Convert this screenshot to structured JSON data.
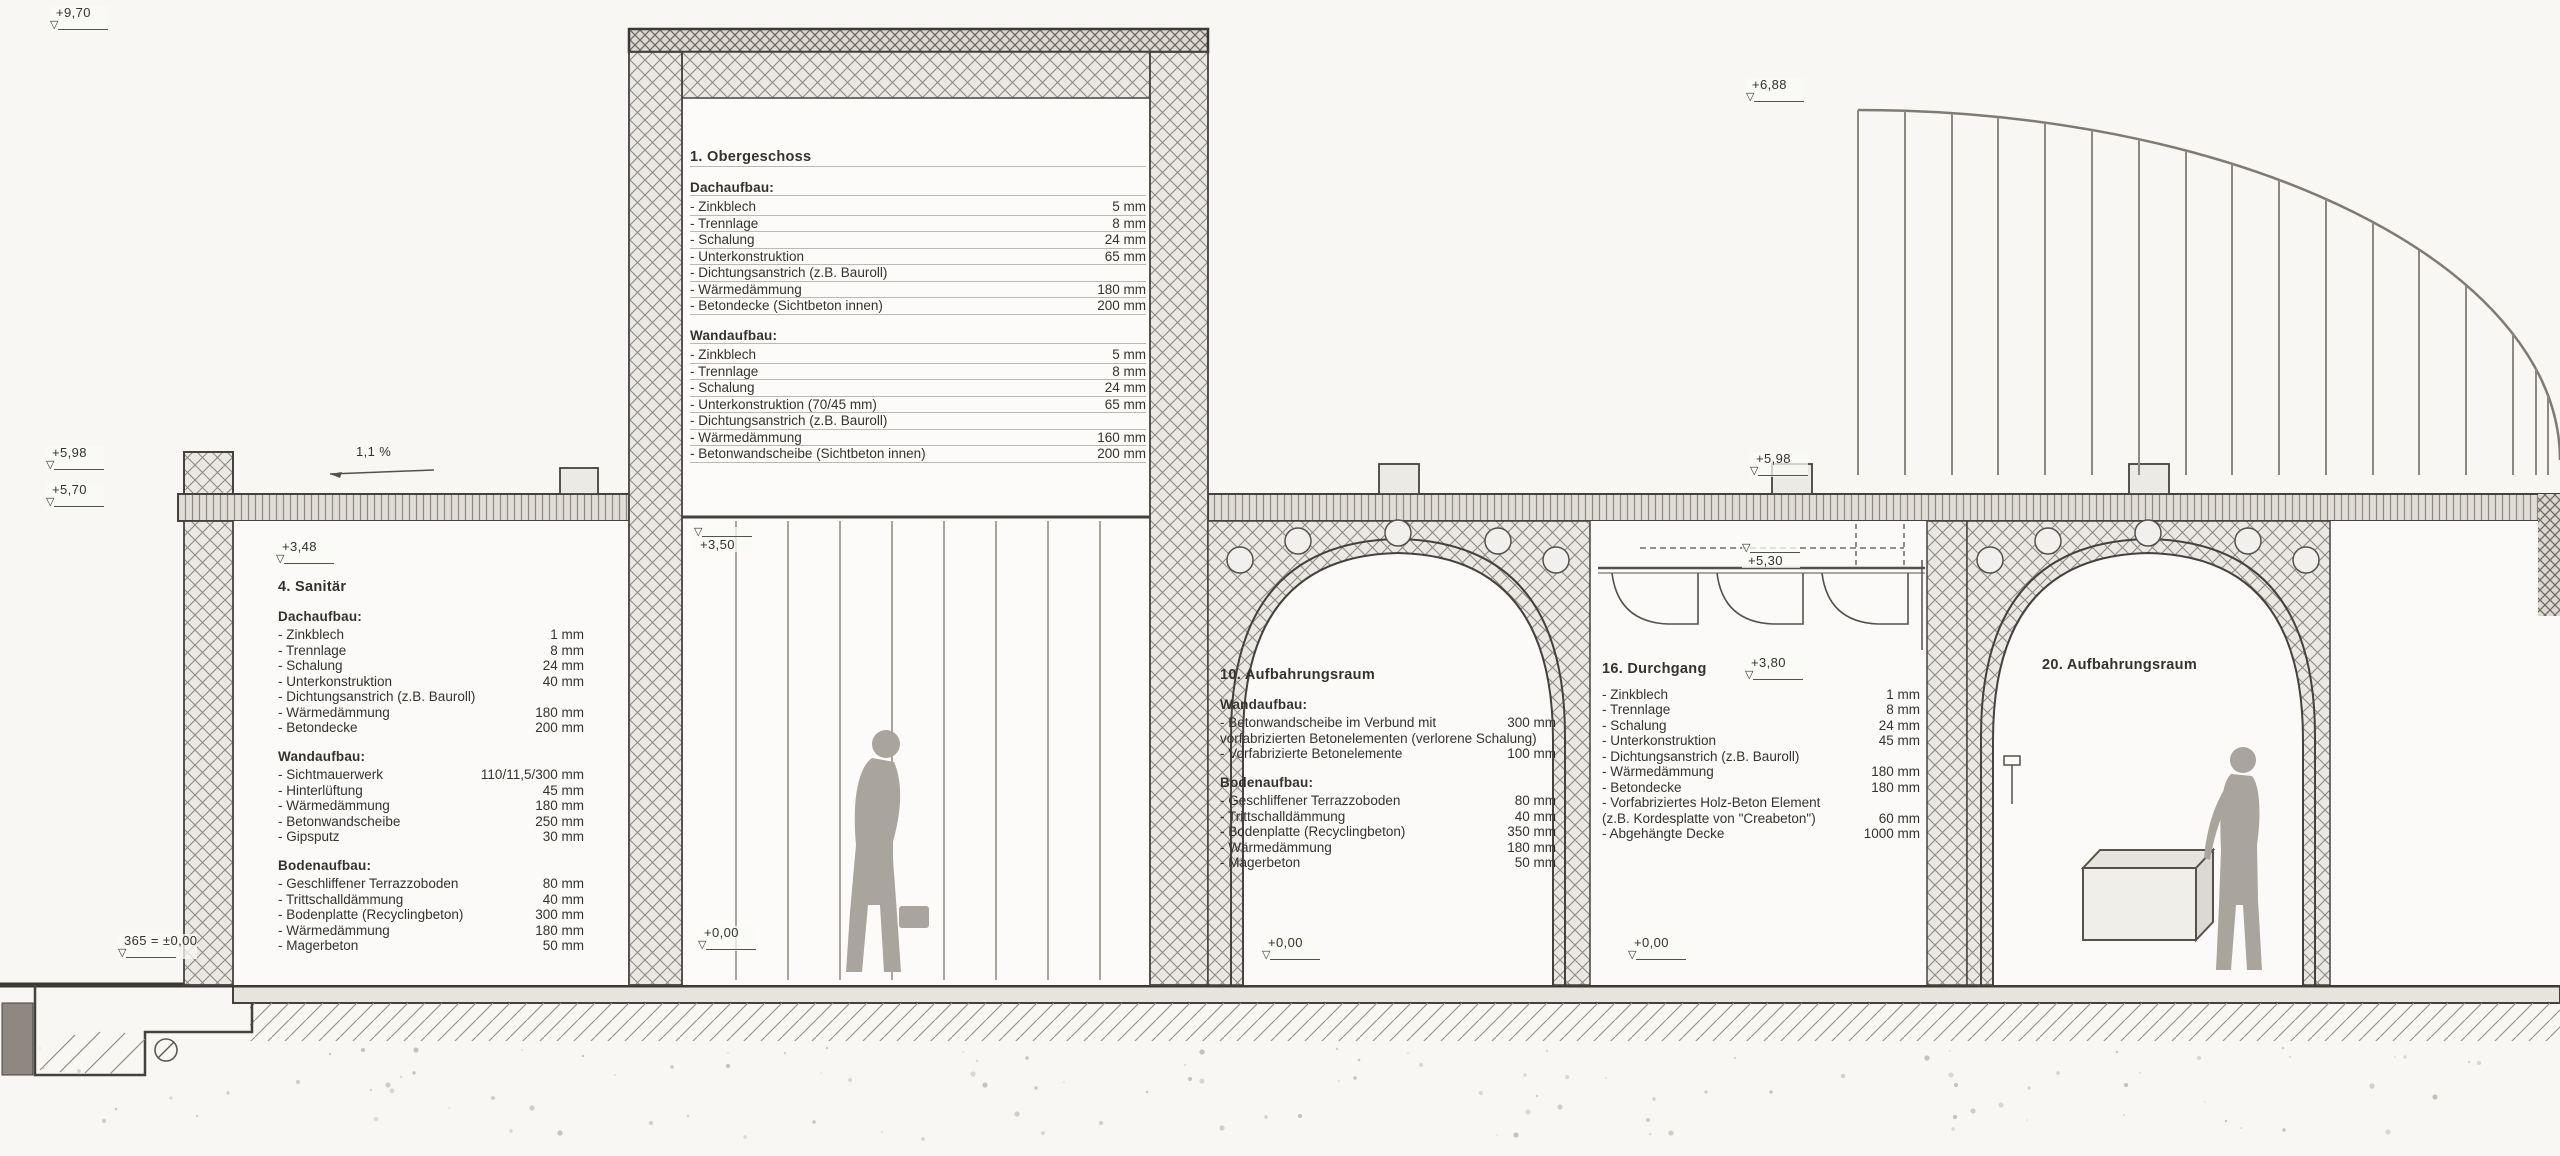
{
  "icons": {
    "level_triangle": "▽"
  },
  "slope_label": "1,1 %",
  "markers": {
    "top_left": "+9,70",
    "left_parapet": "+5,98",
    "left_roof": "+5,70",
    "room4_ceiling": "+3,48",
    "arc_top": "+6,88",
    "right_parapet": "+5,98",
    "right_ceiling": "+5,30",
    "tower_mid": "+3,50",
    "room16_lintel": "+3,80",
    "tower_floor": "+0,00",
    "room10_floor": "+0,00",
    "room16_floor": "+0,00",
    "datum": "365 = ±0,00"
  },
  "blocks": {
    "og": {
      "title": "1. Obergeschoss",
      "sections": [
        {
          "heading": "Dachaufbau:",
          "items": [
            {
              "label": "- Zinkblech",
              "value": "5 mm"
            },
            {
              "label": "- Trennlage",
              "value": "8 mm"
            },
            {
              "label": "- Schalung",
              "value": "24 mm"
            },
            {
              "label": "- Unterkonstruktion",
              "value": "65 mm"
            },
            {
              "label": "- Dichtungsanstrich (z.B. Bauroll)",
              "value": ""
            },
            {
              "label": "- Wärmedämmung",
              "value": "180 mm"
            },
            {
              "label": "- Betondecke (Sichtbeton innen)",
              "value": "200 mm"
            }
          ]
        },
        {
          "heading": "Wandaufbau:",
          "items": [
            {
              "label": "- Zinkblech",
              "value": "5 mm"
            },
            {
              "label": "- Trennlage",
              "value": "8 mm"
            },
            {
              "label": "- Schalung",
              "value": "24 mm"
            },
            {
              "label": "- Unterkonstruktion (70/45 mm)",
              "value": "65 mm"
            },
            {
              "label": "- Dichtungsanstrich (z.B. Bauroll)",
              "value": ""
            },
            {
              "label": "- Wärmedämmung",
              "value": "160 mm"
            },
            {
              "label": "- Betonwandscheibe (Sichtbeton innen)",
              "value": "200 mm"
            }
          ]
        }
      ]
    },
    "room4": {
      "title": "4. Sanitär",
      "sections": [
        {
          "heading": "Dachaufbau:",
          "items": [
            {
              "label": "- Zinkblech",
              "value": "1 mm"
            },
            {
              "label": "- Trennlage",
              "value": "8 mm"
            },
            {
              "label": "- Schalung",
              "value": "24 mm"
            },
            {
              "label": "- Unterkonstruktion",
              "value": "40 mm"
            },
            {
              "label": "- Dichtungsanstrich (z.B. Bauroll)",
              "value": ""
            },
            {
              "label": "- Wärmedämmung",
              "value": "180 mm"
            },
            {
              "label": "- Betondecke",
              "value": "200 mm"
            }
          ]
        },
        {
          "heading": "Wandaufbau:",
          "items": [
            {
              "label": "- Sichtmauerwerk",
              "value": "110/11,5/300 mm"
            },
            {
              "label": "- Hinterlüftung",
              "value": "45 mm"
            },
            {
              "label": "- Wärmedämmung",
              "value": "180 mm"
            },
            {
              "label": "- Betonwandscheibe",
              "value": "250 mm"
            },
            {
              "label": "- Gipsputz",
              "value": "30 mm"
            }
          ]
        },
        {
          "heading": "Bodenaufbau:",
          "items": [
            {
              "label": "- Geschliffener Terrazzoboden",
              "value": "80 mm"
            },
            {
              "label": "- Trittschalldämmung",
              "value": "40 mm"
            },
            {
              "label": "- Bodenplatte (Recyclingbeton)",
              "value": "300 mm"
            },
            {
              "label": "- Wärmedämmung",
              "value": "180 mm"
            },
            {
              "label": "- Magerbeton",
              "value": "50 mm"
            }
          ]
        }
      ]
    },
    "room10": {
      "title": "10. Aufbahrungsraum",
      "sections": [
        {
          "heading": "Wandaufbau:",
          "items": [
            {
              "label": "- Betonwandscheibe im Verbund mit",
              "value": "300 mm"
            },
            {
              "label": "  vorfabrizierten Betonelementen (verlorene Schalung)",
              "value": ""
            },
            {
              "label": "- Vorfabrizierte Betonelemente",
              "value": "100 mm"
            }
          ]
        },
        {
          "heading": "Bodenaufbau:",
          "items": [
            {
              "label": "- Geschliffener Terrazzoboden",
              "value": "80 mm"
            },
            {
              "label": "- Trittschalldämmung",
              "value": "40 mm"
            },
            {
              "label": "- Bodenplatte (Recyclingbeton)",
              "value": "350 mm"
            },
            {
              "label": "- Wärmedämmung",
              "value": "180 mm"
            },
            {
              "label": "- Magerbeton",
              "value": "50 mm"
            }
          ]
        }
      ]
    },
    "room16": {
      "title": "16. Durchgang",
      "sections": [
        {
          "heading": "",
          "items": [
            {
              "label": "- Zinkblech",
              "value": "1 mm"
            },
            {
              "label": "- Trennlage",
              "value": "8 mm"
            },
            {
              "label": "- Schalung",
              "value": "24 mm"
            },
            {
              "label": "- Unterkonstruktion",
              "value": "45 mm"
            },
            {
              "label": "- Dichtungsanstrich (z.B. Bauroll)",
              "value": ""
            },
            {
              "label": "- Wärmedämmung",
              "value": "180 mm"
            },
            {
              "label": "- Betondecke",
              "value": "180 mm"
            },
            {
              "label": "- Vorfabriziertes Holz-Beton Element",
              "value": ""
            },
            {
              "label": "  (z.B. Kordesplatte von \"Creabeton\")",
              "value": "60 mm"
            },
            {
              "label": "- Abgehängte Decke",
              "value": "1000 mm"
            }
          ]
        }
      ]
    },
    "room20": {
      "title": "20. Aufbahrungsraum",
      "sections": []
    }
  }
}
